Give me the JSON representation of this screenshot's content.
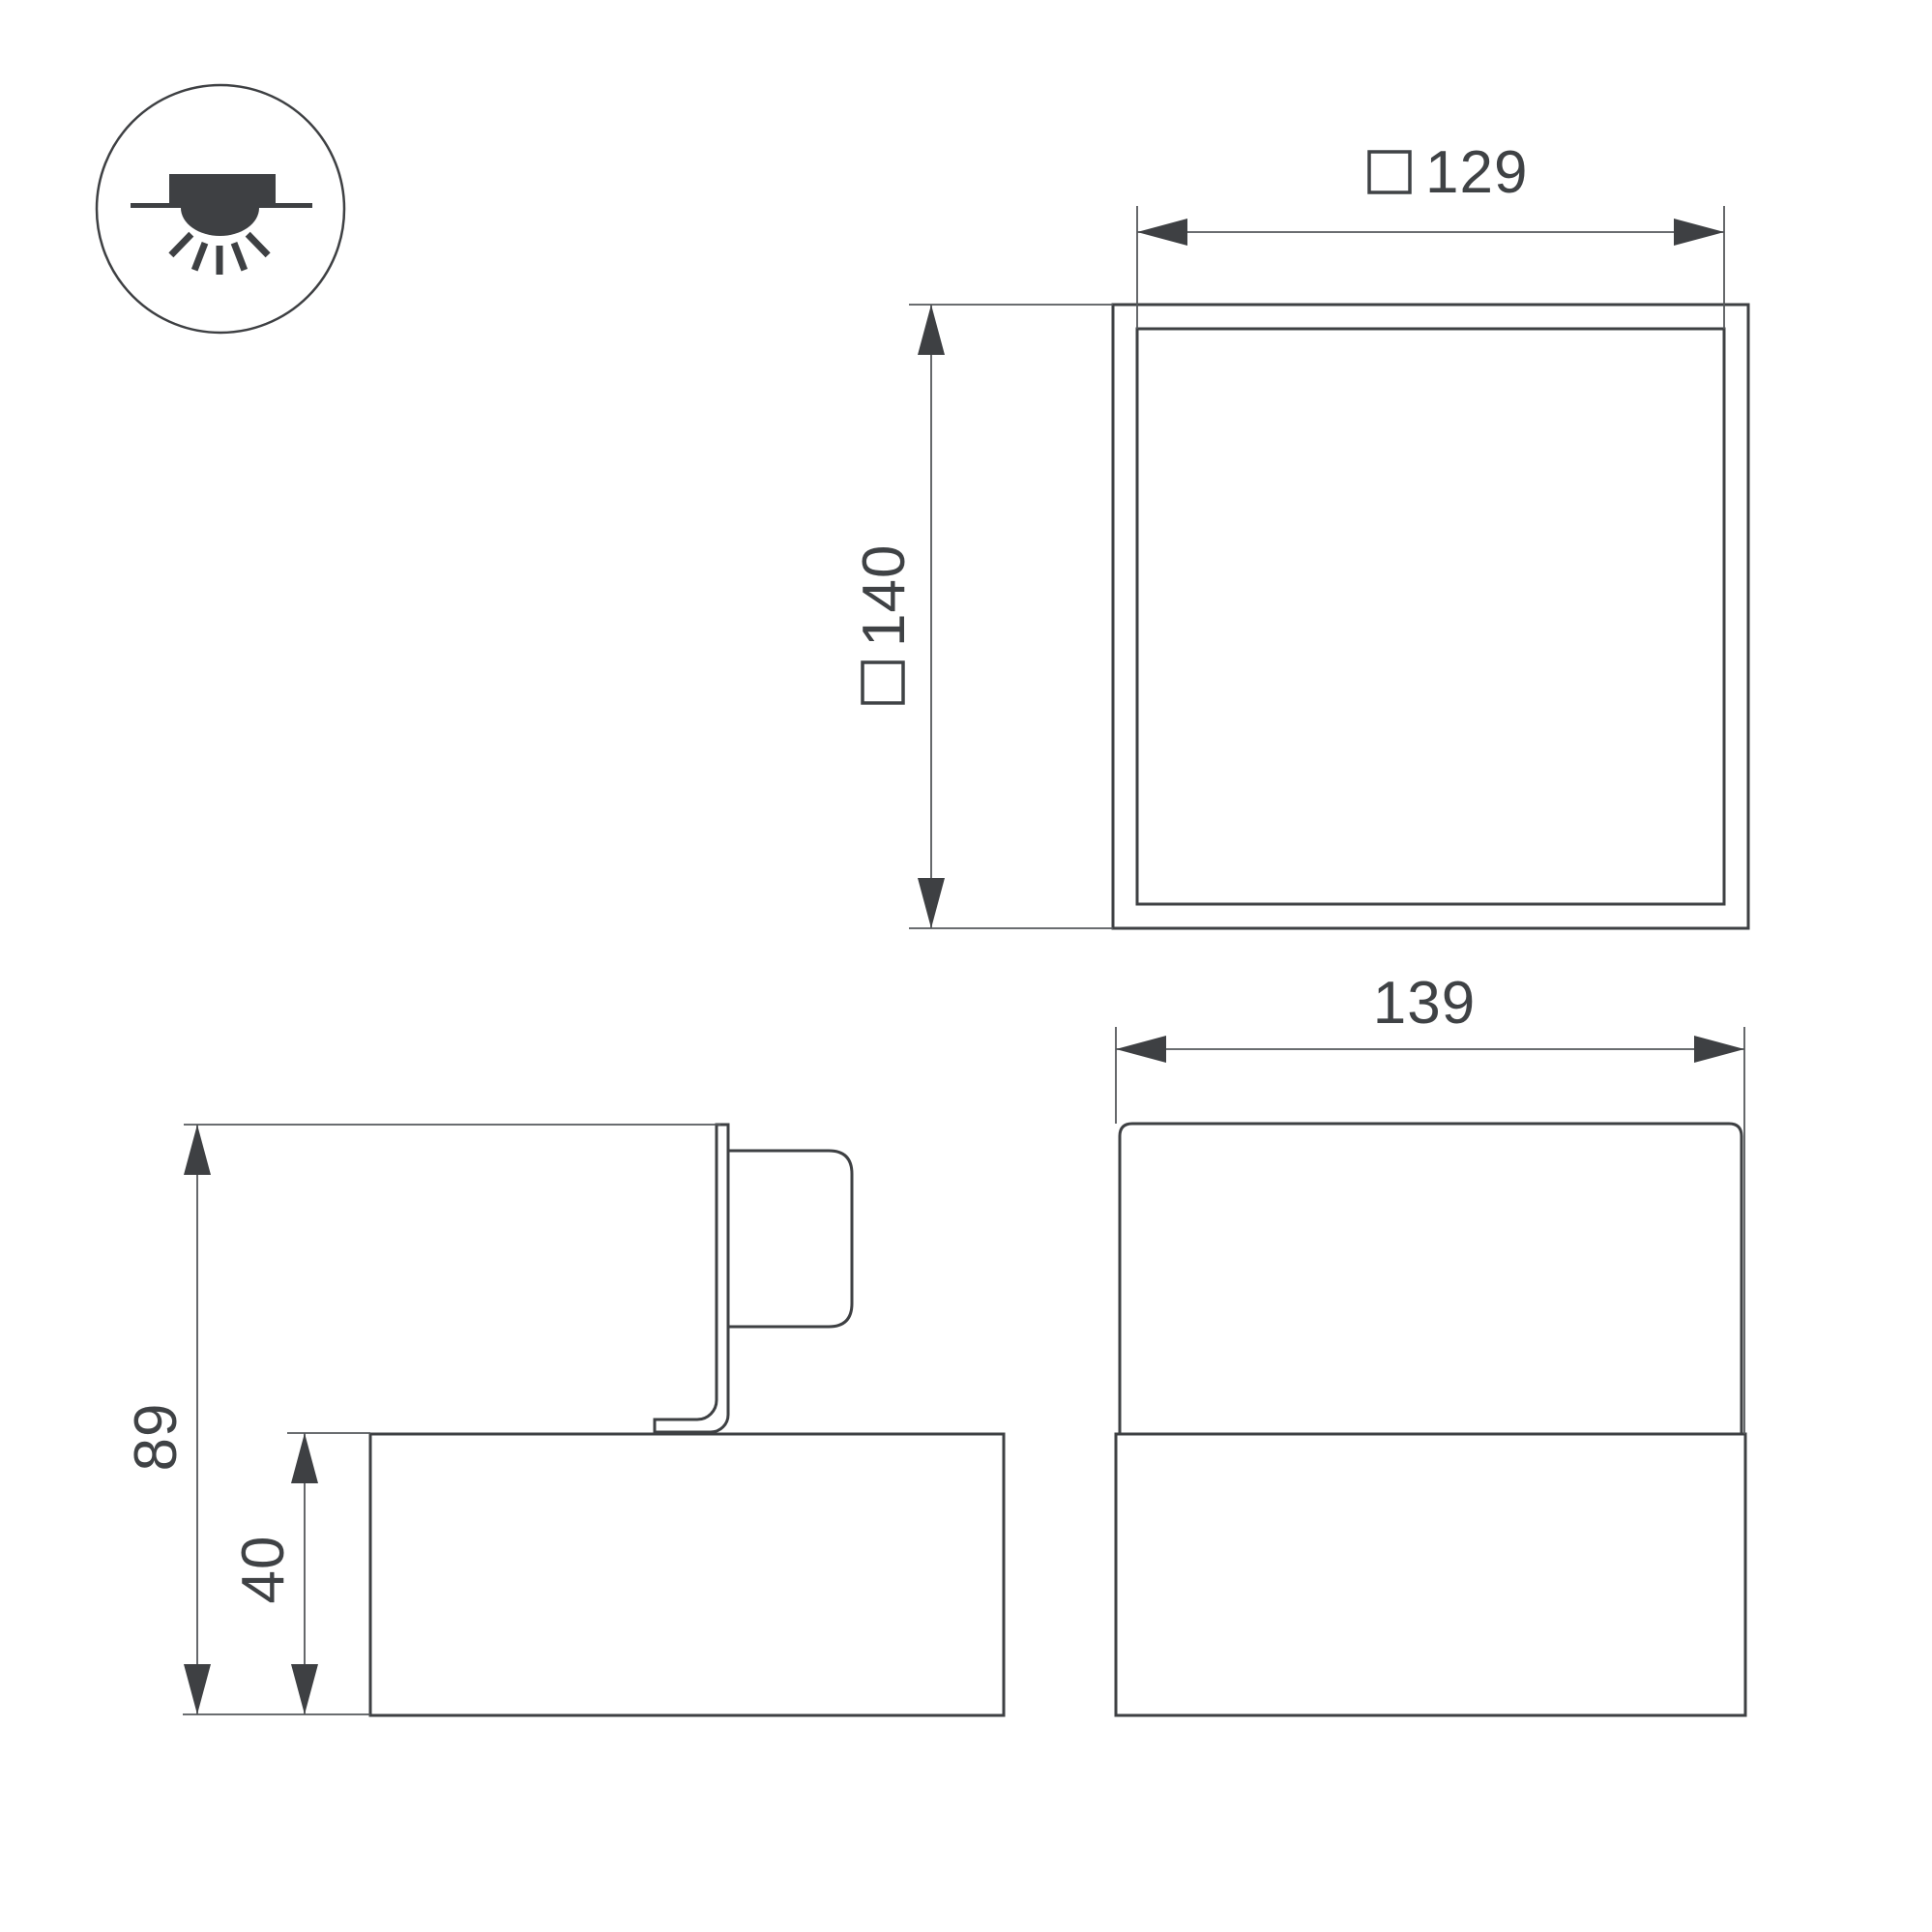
{
  "page": {
    "background": "#ffffff",
    "line_color": "#3e4043",
    "dim_line_color": "#55585b",
    "text_color": "#3f4245",
    "title": "Luminaire dimensional drawing"
  },
  "mount_icon": {
    "name": "surface-ceiling-mount-light-icon",
    "meaning": "surface mounted ceiling light, light emitted downward"
  },
  "top_view": {
    "name": "top view (plan)",
    "dim_inner_width": {
      "symbol": "□",
      "value": "129"
    },
    "dim_outer_height": {
      "symbol": "□",
      "value": "140"
    }
  },
  "side_view": {
    "name": "side view",
    "dim_total_height": {
      "value": "89"
    },
    "dim_base_height": {
      "value": "40"
    }
  },
  "front_view": {
    "name": "front view",
    "dim_width": {
      "value": "139"
    }
  }
}
